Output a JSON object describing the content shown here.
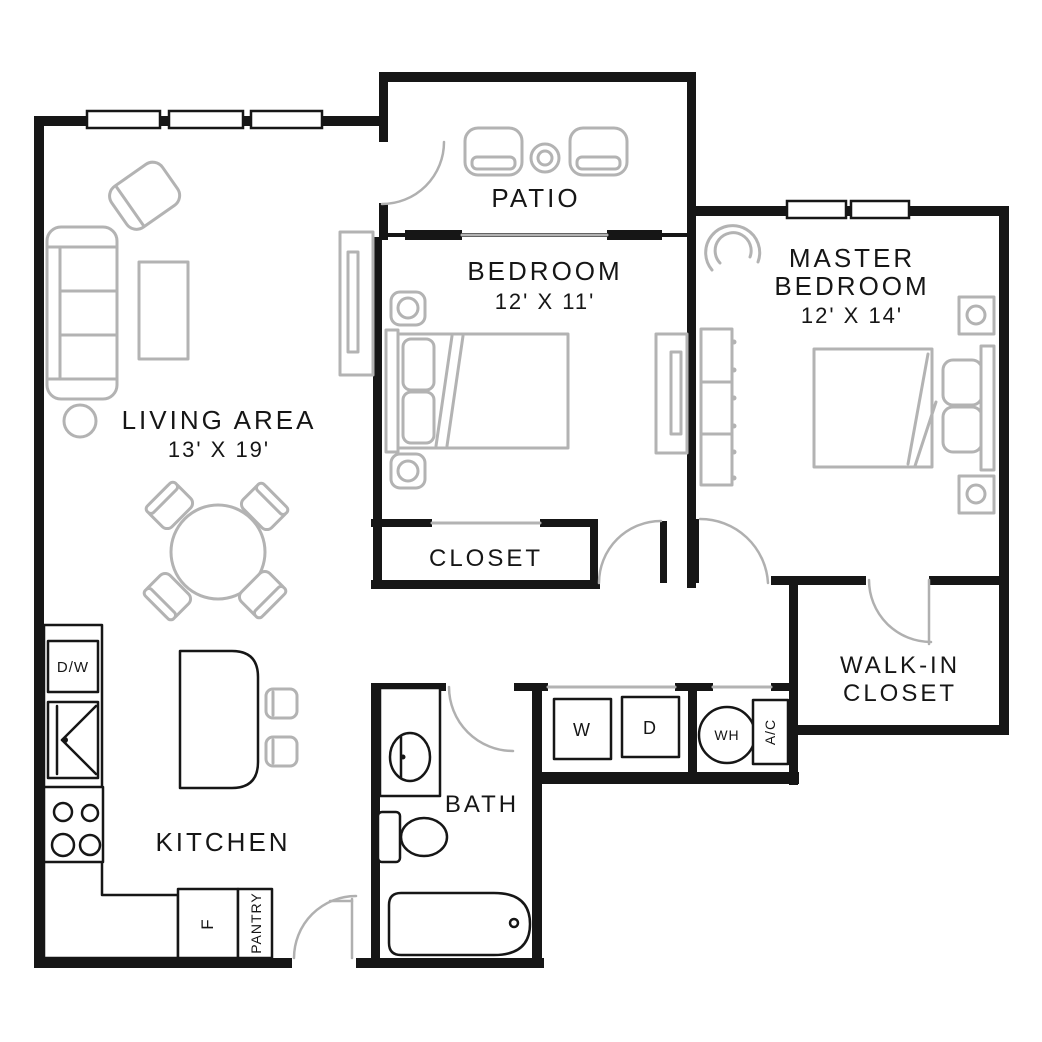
{
  "colors": {
    "wall": "#161616",
    "furniture": "#b3b3b3",
    "background": "#ffffff"
  },
  "rooms": {
    "patio": {
      "label": "PATIO"
    },
    "bedroom": {
      "label": "BEDROOM",
      "dimensions": "12' X 11'"
    },
    "master_bedroom": {
      "label_line1": "MASTER",
      "label_line2": "BEDROOM",
      "dimensions": "12' X 14'"
    },
    "living_area": {
      "label": "LIVING AREA",
      "dimensions": "13' X 19'"
    },
    "closet": {
      "label": "CLOSET"
    },
    "walk_in_closet": {
      "label_line1": "WALK-IN",
      "label_line2": "CLOSET"
    },
    "kitchen": {
      "label": "KITCHEN"
    },
    "bath": {
      "label": "BATH"
    }
  },
  "appliances": {
    "dishwasher": "D/W",
    "washer": "W",
    "dryer": "D",
    "water_heater": "WH",
    "air_conditioner": "A/C",
    "refrigerator": "F",
    "pantry": "PANTRY"
  }
}
